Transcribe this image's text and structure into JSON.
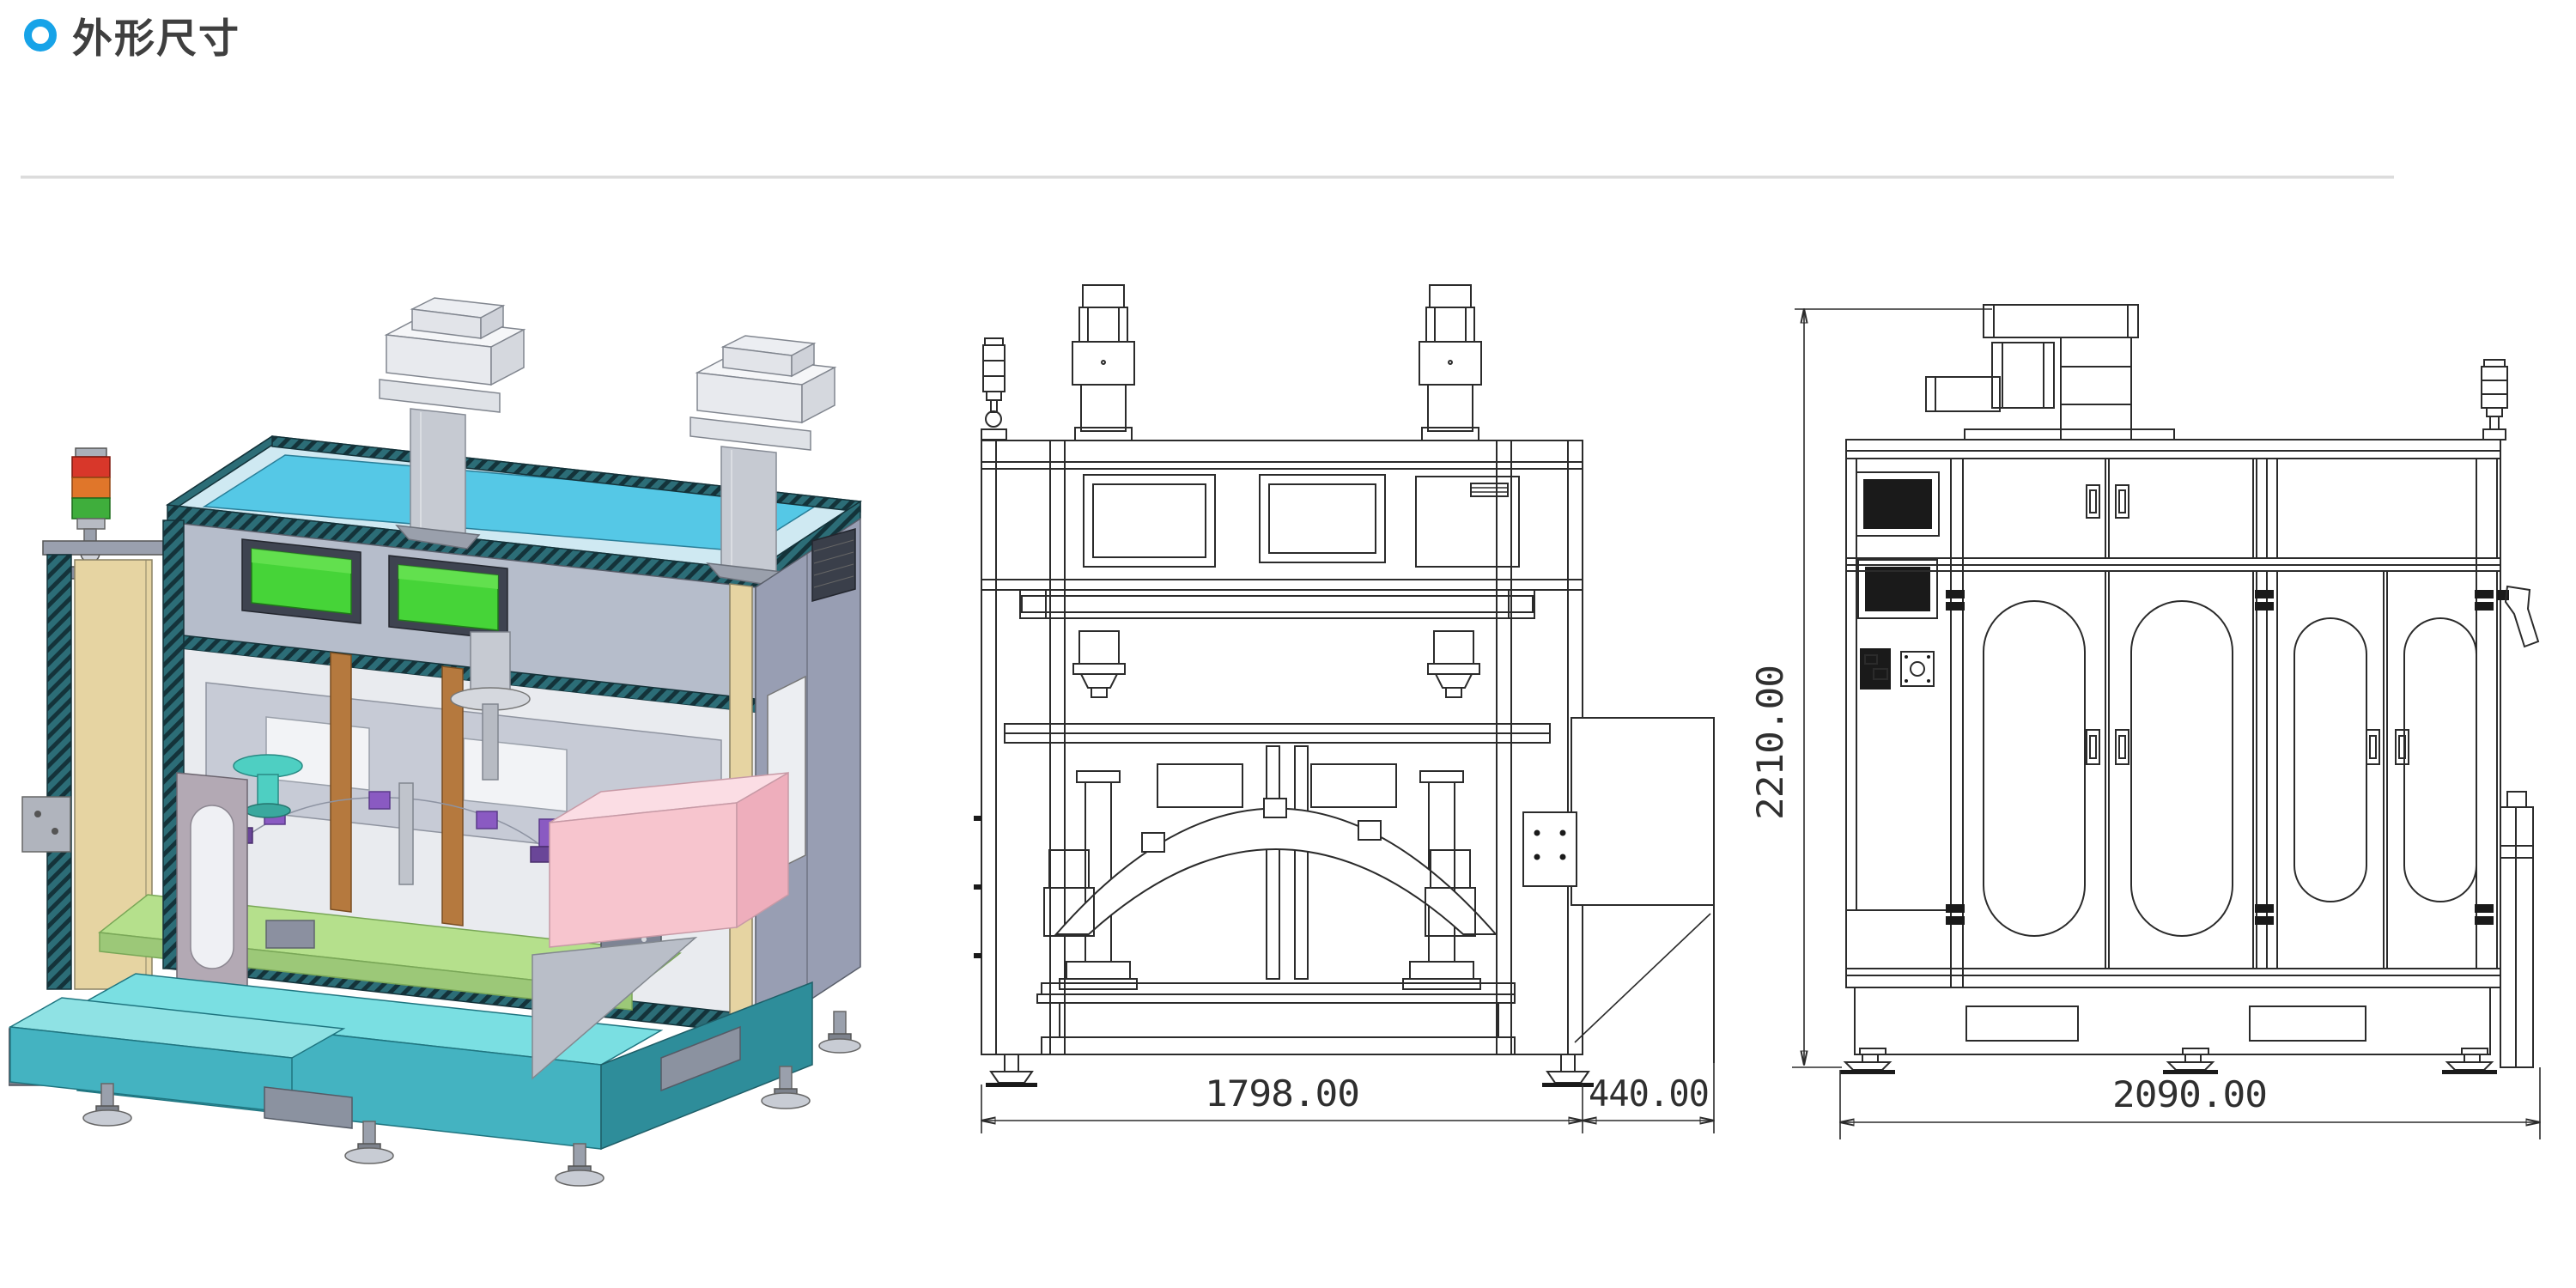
{
  "header": {
    "title": "外形尺寸",
    "bullet_color": "#17a3e8",
    "title_color": "#3f3f3f",
    "divider_color": "#dcdcdc"
  },
  "drawings": {
    "stroke_color": "#2b2b2b",
    "front_view": {
      "width_dim": "1798.00",
      "chute_dim": "440.00"
    },
    "side_view": {
      "height_dim": "2210.00",
      "width_dim": "2090.00"
    }
  },
  "render_3d": {
    "colors": {
      "roof_cyan": "#55c8e6",
      "frame_teal": "#2c6d77",
      "panel_gray": "#b6bdcb",
      "side_gray": "#989eb3",
      "screen_green": "#46d438",
      "tan": "#e6d4a2",
      "copper": "#b5793e",
      "table_green": "#b5e08c",
      "pink": "#f7c5ce",
      "base_teal": "#44b3c1",
      "base_teal_dark": "#2e8d9a",
      "base_teal_top": "#7adfe2",
      "tower_red": "#d8372a",
      "tower_orange": "#e0762a",
      "tower_green": "#3fae3c",
      "metal": "#c6cad2"
    }
  }
}
